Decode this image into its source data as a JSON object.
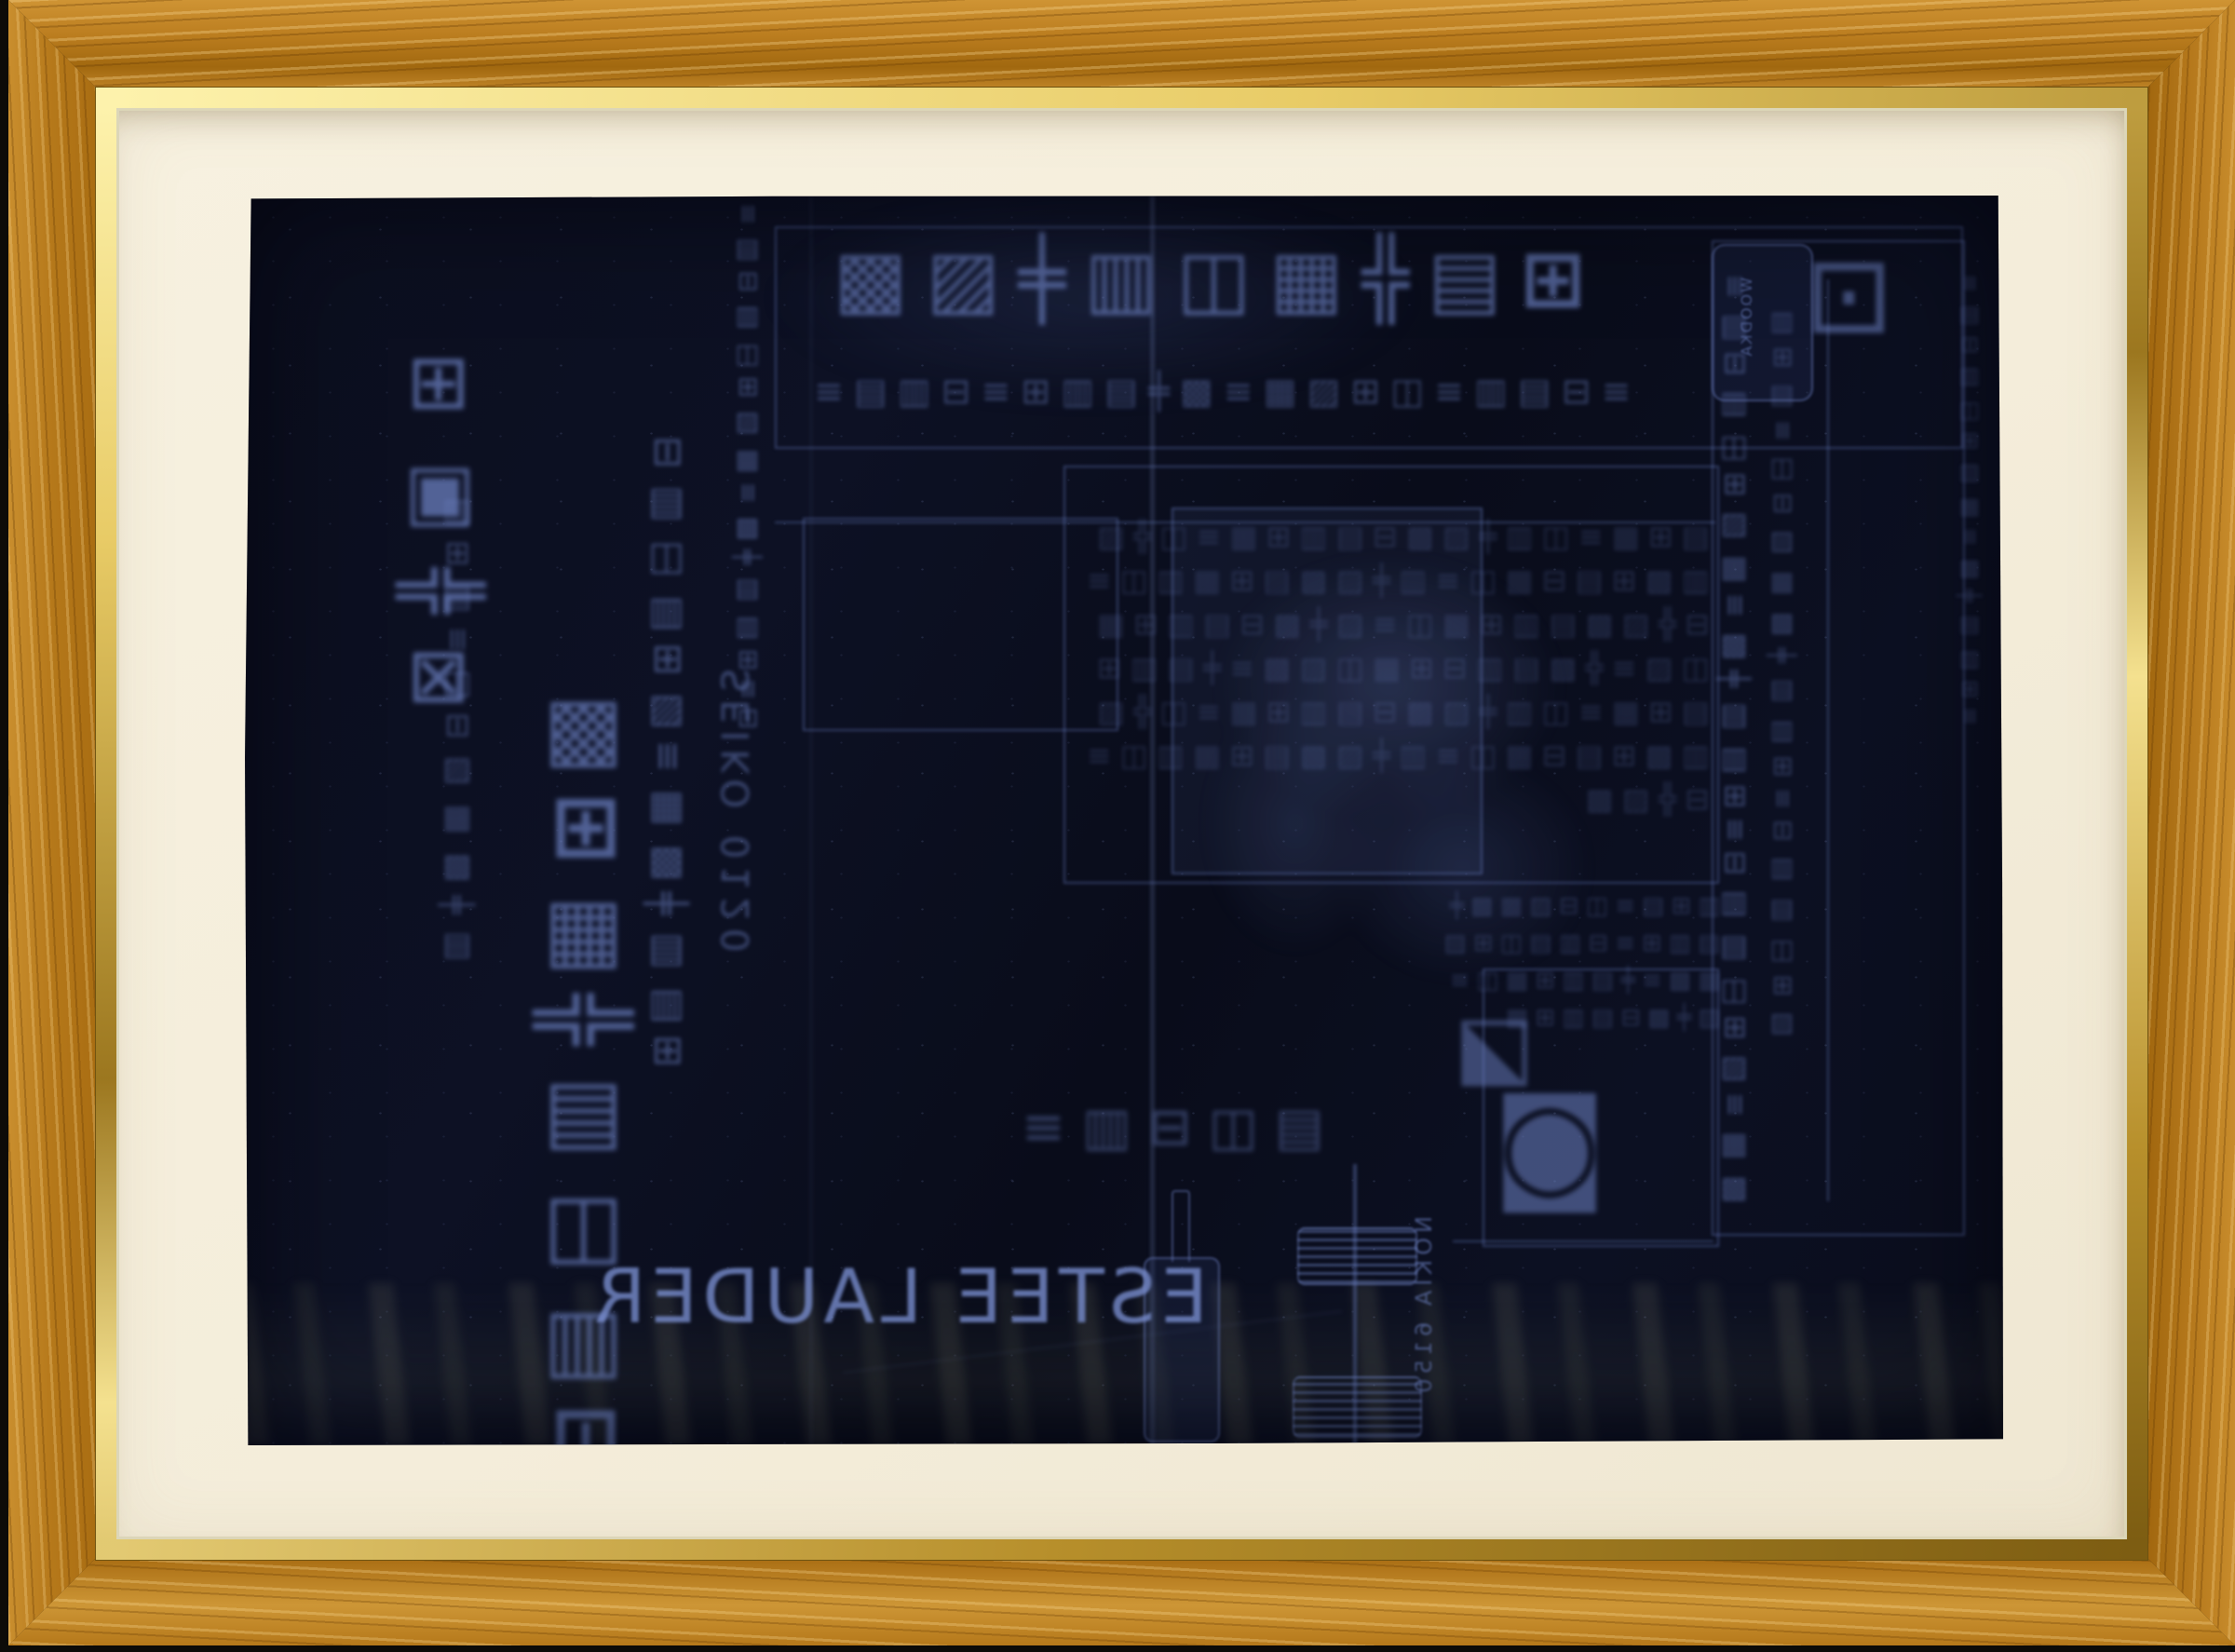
{
  "image_type": "photograph of a framed artwork",
  "frame": {
    "material": "oak wood with gold lip",
    "wood_color": "#b5781a",
    "gold_lip_color": "#e8cb66",
    "mat_color": "#f4edda"
  },
  "paper": {
    "description": "dark navy-black carbon paper with faint blue mirrored newspaper rubbings, creases and sheen",
    "background_color": "#0b0e1e",
    "ink_color": "#6d82c4"
  },
  "inscriptions": {
    "brand": "ESTEE LAUDER",
    "nokia": "NOKIA 6150",
    "seiko_phone": "SEIKO 0120",
    "bottle_label": "WOODKA",
    "headline_glyphs": "⊞▤╬▦◫▥╪▧▩",
    "subheadline_glyphs": "≡⊟▤▥≡◫⊞▧▦≡▩╪▤▥⊞≡⊟▥▤≡",
    "left_caption_glyphs": "⊞▣╬⊠",
    "big_column_glyphs": "▩⊞▦╬▤◫▥⊟",
    "column2_glyphs": "⊟▤◫▥⊞▧≡▦▩╪▤▥⊞",
    "column3_glyphs": "▥⊞▤≡◫⊟▧▦▩╪▤",
    "small_left_column_glyphs": "≡▤⊟▥◫⊞▧▦≡▩╪▤▥⊞≡⊟",
    "right_column1_glyphs": "≡▤⊟▥◫⊞▧▦≡▩╪▤▥⊞≡⊟▥▤◫⊞▧≡▦▩",
    "right_column2_glyphs": "▥⊞▤≡◫⊟▧▦▩╪▤▥⊞≡⊟▥▤◫⊞▧",
    "right_column3_glyphs": "≡▤⊟▥◫⊞▧▦≡▩╪▤▥⊞≡",
    "bottom_row_glyphs": "▤◫⊟▥≡",
    "name_char": "◪",
    "round_seal_char": "◙",
    "topright_char": "⊡",
    "dense_block_glyphs": "▤⊞▦≡◫▥╪▧▩⊟▤▥⊞▦≡◫╬▧▥▩⊞▤⊟▦◫≡▥╪▧▩▤⊞▦▥◫≡⊟╬▧▩▤▥⊞▦◫≡▧╪▩⊟▤▥⊞▦◫▧≡╬▩▤▥⊟⊞▦◫▧▩≡╪▤▥⊞▤⊞▦≡◫▥╪▧▩⊟▤▥⊞▦≡◫╬▧▥▩⊞▤⊟▦◫≡▥╪▧▩▤⊞▦▥◫≡⊟╬▧▩",
    "dense_block2_glyphs": "▥⊞▤≡◫⊟▧▦▩╪▤▥⊞≡⊟▥▤◫⊞▧▦▩≡╪▤▥⊞▦◫≡▧╪▩⊟▤▥⊞▦"
  }
}
